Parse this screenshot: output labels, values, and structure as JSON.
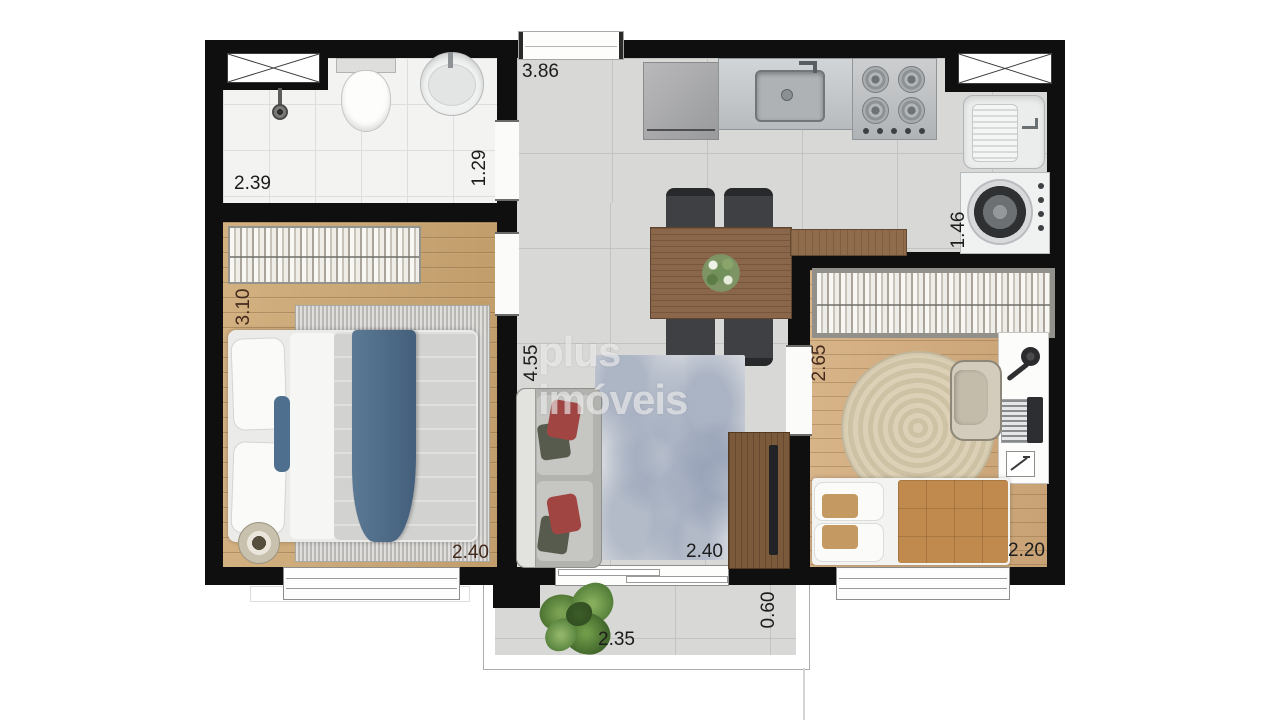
{
  "watermark": "plus imóveis",
  "dimensions": {
    "kitchen_width": "3.86",
    "bathroom_width": "2.39",
    "bathroom_depth": "1.29",
    "bedroom1_depth": "3.10",
    "bedroom1_width": "2.40",
    "living_depth": "4.55",
    "living_width": "2.40",
    "laundry_depth": "1.46",
    "bedroom2_depth": "2.65",
    "bedroom2_width": "2.20",
    "balcony_width": "2.35",
    "balcony_depth": "0.60"
  },
  "rooms": {
    "bathroom": {
      "fixtures": [
        "shaft-box",
        "shower-head",
        "toilet",
        "round-sink"
      ]
    },
    "kitchen_living": {
      "fixtures": [
        "entry-door",
        "counter-cabinet",
        "kitchen-sink-counter",
        "cooktop-4-burners",
        "dining-table",
        "dining-chairs-x4",
        "plant-centerpiece",
        "sideboard",
        "sofa-with-red-pillows",
        "area-rug",
        "tv-console",
        "sliding-balcony-door"
      ]
    },
    "laundry": {
      "fixtures": [
        "shaft-box",
        "laundry-tank",
        "washing-machine"
      ]
    },
    "bedroom1": {
      "fixtures": [
        "wardrobe-hangers",
        "double-bed-blue-throw",
        "bedside-rug",
        "round-pouf",
        "window"
      ]
    },
    "bedroom2": {
      "fixtures": [
        "wardrobe-hangers",
        "round-jute-rug",
        "desk",
        "desk-lamp",
        "laptop",
        "notepad",
        "desk-chair",
        "single-bed-caramel-blanket",
        "window"
      ]
    },
    "balcony": {
      "fixtures": [
        "potted-plant"
      ]
    }
  },
  "colors": {
    "wall": "#0f0f0f",
    "tile_floor": "#d8d8d6",
    "bath_tile": "#f3f3f2",
    "wood_floor_1": "#cda772",
    "wood_floor_2": "#d3ab7b",
    "table_wood": "#8a674a",
    "tv_console_wood": "#7b5a3b",
    "blue_throw": "#4f6d8a",
    "red_pillow": "#a04542",
    "caramel_blanket": "#c08a4f",
    "jute_rug": "#d6c9ae",
    "watermark_white": "#ffffff"
  }
}
